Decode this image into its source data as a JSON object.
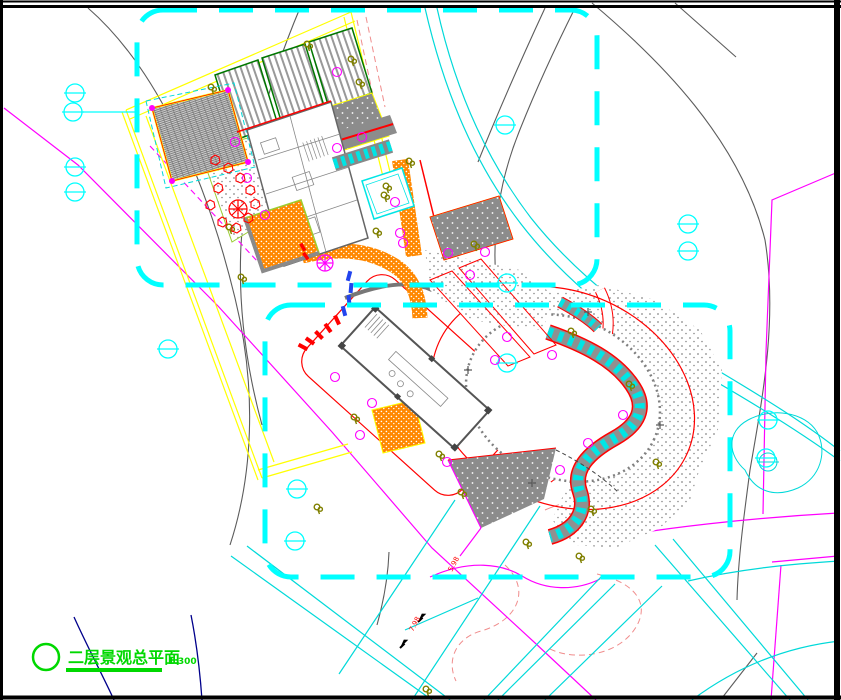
{
  "title_block": {
    "label": "二层景观总平面",
    "scale": "1:300"
  },
  "road_labels": [
    {
      "text": "7.98",
      "x": 413,
      "y": 632,
      "rot": -62
    },
    {
      "text": "5.98",
      "x": 452,
      "y": 572,
      "rot": -62
    }
  ],
  "palette": {
    "frame": "#000000",
    "boundary_dash": "#00ffff",
    "road": "#00d9d9",
    "contour": "#5c5c5c",
    "contour_minor": "#f08c8c",
    "parcel": "#ffff00",
    "property": "#ff00ff",
    "paving": "#ff8800",
    "roof": "#8c8c8c",
    "accent_red": "#ff0000",
    "planting": "#808000",
    "title_green": "#00d800",
    "deep_blue": "#00008b"
  },
  "symbols": {
    "survey_marks": [
      [
        75,
        93
      ],
      [
        73,
        112
      ],
      [
        75,
        167
      ],
      [
        75,
        192
      ],
      [
        168,
        349
      ],
      [
        505,
        125
      ],
      [
        507,
        283
      ],
      [
        507,
        363
      ],
      [
        688,
        224
      ],
      [
        688,
        251
      ],
      [
        297,
        489
      ],
      [
        295,
        541
      ],
      [
        768,
        420
      ],
      [
        766,
        458
      ]
    ],
    "trees": [
      [
        212,
        88
      ],
      [
        308,
        45
      ],
      [
        352,
        60
      ],
      [
        360,
        83
      ],
      [
        410,
        162
      ],
      [
        387,
        187
      ],
      [
        377,
        232
      ],
      [
        475,
        245
      ],
      [
        385,
        196
      ],
      [
        230,
        228
      ],
      [
        242,
        278
      ],
      [
        318,
        508
      ],
      [
        355,
        418
      ],
      [
        440,
        455
      ],
      [
        462,
        493
      ],
      [
        527,
        543
      ],
      [
        580,
        557
      ],
      [
        592,
        510
      ],
      [
        572,
        332
      ],
      [
        630,
        385
      ],
      [
        657,
        463
      ],
      [
        427,
        690
      ]
    ],
    "shrubs": [
      [
        337,
        72
      ],
      [
        362,
        137
      ],
      [
        337,
        148
      ],
      [
        235,
        142
      ],
      [
        247,
        178
      ],
      [
        265,
        215
      ],
      [
        400,
        233
      ],
      [
        403,
        243
      ],
      [
        507,
        337
      ],
      [
        495,
        360
      ],
      [
        335,
        377
      ],
      [
        372,
        403
      ],
      [
        360,
        435
      ],
      [
        447,
        462
      ],
      [
        552,
        355
      ],
      [
        623,
        415
      ],
      [
        588,
        443
      ],
      [
        560,
        470
      ],
      [
        395,
        202
      ],
      [
        448,
        253
      ],
      [
        485,
        252
      ],
      [
        470,
        275
      ]
    ],
    "rocks": [
      [
        215,
        160
      ],
      [
        228,
        168
      ],
      [
        240,
        178
      ],
      [
        250,
        190
      ],
      [
        255,
        204
      ],
      [
        248,
        218
      ],
      [
        236,
        228
      ],
      [
        222,
        222
      ],
      [
        210,
        205
      ],
      [
        218,
        188
      ]
    ],
    "plus_marks": [
      [
        660,
        425
      ],
      [
        468,
        370
      ],
      [
        588,
        312
      ],
      [
        532,
        483
      ]
    ],
    "arrows": [
      [
        418,
        622,
        -25
      ],
      [
        400,
        648,
        -25
      ]
    ]
  }
}
